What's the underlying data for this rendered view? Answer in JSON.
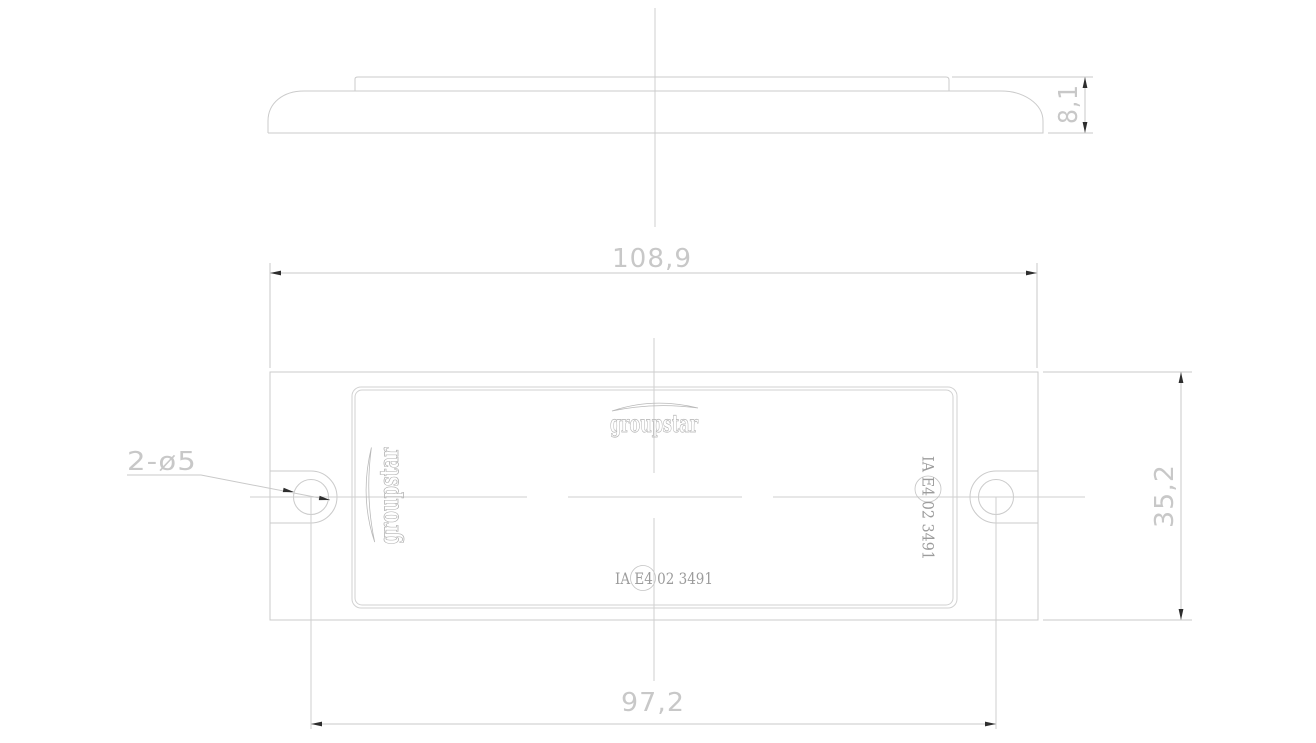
{
  "colors": {
    "background": "#ffffff",
    "geometry_line": "#cbcbcb",
    "centerline": "#cfcfcf",
    "dimension_text": "#c8c8c8",
    "marking_text": "#9c9c9c",
    "logo_outline": "#b2b2b2",
    "arrowhead": "#2e2e2e"
  },
  "dims": {
    "overall_width": "108,9",
    "overall_height": "35,2",
    "thickness": "8,1",
    "hole_spacing": "97,2",
    "holes_callout": "2-ø5"
  },
  "markings": {
    "brand": "groupstar",
    "approval": "IA E4 02 3491"
  }
}
